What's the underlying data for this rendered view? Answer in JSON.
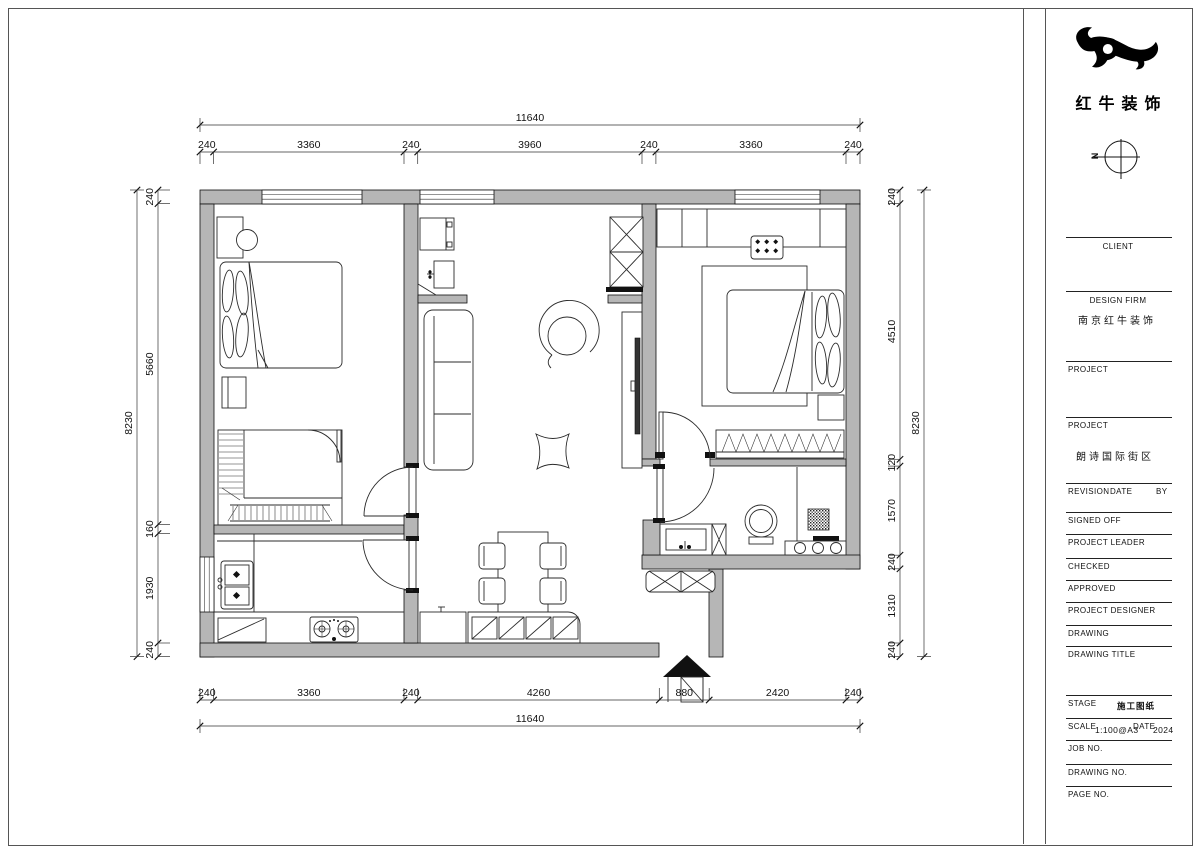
{
  "brand": {
    "name": "红牛装饰"
  },
  "compass": {
    "north": "N"
  },
  "title_block": {
    "client_label": "CLIENT",
    "design_firm_label": "DESIGN FIRM",
    "design_firm_value": "南京红牛装饰",
    "project1_label": "PROJECT",
    "project2_label": "PROJECT",
    "project_value": "朗诗国际街区",
    "revision_label": "REVISION",
    "date_col_label": "DATE",
    "by_label": "BY",
    "signed_off_label": "SIGNED OFF",
    "project_leader_label": "PROJECT LEADER",
    "checked_label": "CHECKED",
    "approved_label": "APPROVED",
    "project_designer_label": "PROJECT DESIGNER",
    "drawing_label": "DRAWING",
    "drawing_title_label": "DRAWING TITLE",
    "stage_label": "STAGE",
    "stage_value": "施工图纸",
    "scale_label": "SCALE",
    "scale_value": "1:100@A3",
    "date_label": "DATE",
    "date_value": "2024",
    "job_no_label": "JOB NO.",
    "drawing_no_label": "DRAWING NO.",
    "page_no_label": "PAGE NO."
  },
  "plan": {
    "dimensions": {
      "top_overall": "11640",
      "top_segments": [
        "240",
        "3360",
        "240",
        "3960",
        "240",
        "3360",
        "240"
      ],
      "bottom_segments": [
        "240",
        "3360",
        "240",
        "4260",
        "880",
        "2420",
        "240"
      ],
      "bottom_overall": "11640",
      "left_segments": [
        "240",
        "5660",
        "160",
        "1930",
        "240"
      ],
      "left_overall": "8230",
      "right_segments": [
        "240",
        "4510",
        "120",
        "1570",
        "240",
        "1310",
        "240"
      ],
      "right_overall": "8230"
    }
  }
}
